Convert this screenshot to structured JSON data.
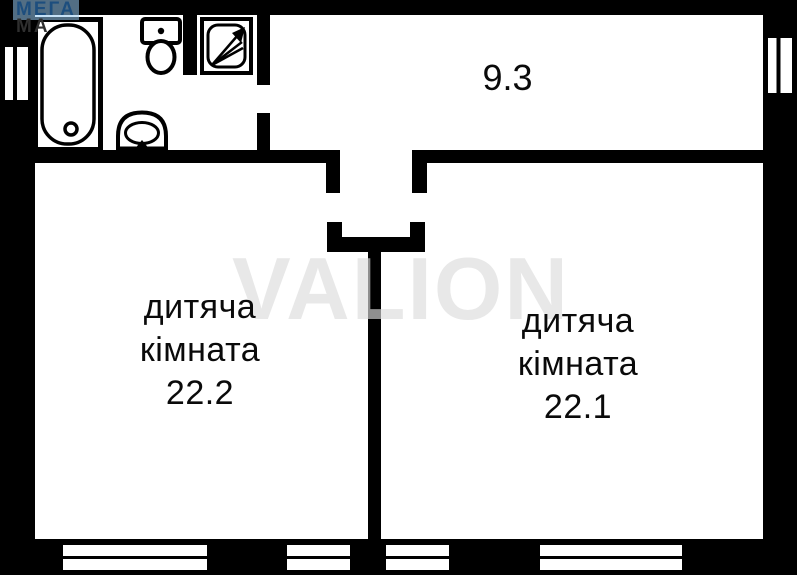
{
  "logo": {
    "line1": "МЕГА",
    "line2": "МА"
  },
  "watermark": "VALION",
  "hallway": {
    "area": "9.3"
  },
  "rooms": [
    {
      "name_line1": "дитяча",
      "name_line2": "кімната",
      "area": "22.2"
    },
    {
      "name_line1": "дитяча",
      "name_line2": "кімната",
      "area": "22.1"
    }
  ],
  "fixtures": [
    "bathtub-icon",
    "toilet-icon",
    "shower-icon",
    "sink-icon"
  ],
  "colors": {
    "wall": "#000000",
    "floor": "#ffffff",
    "logo_blue": "#1d4e7e",
    "logo_highlight": "#a9d0ec",
    "watermark_gray": "#dcdcdc"
  }
}
